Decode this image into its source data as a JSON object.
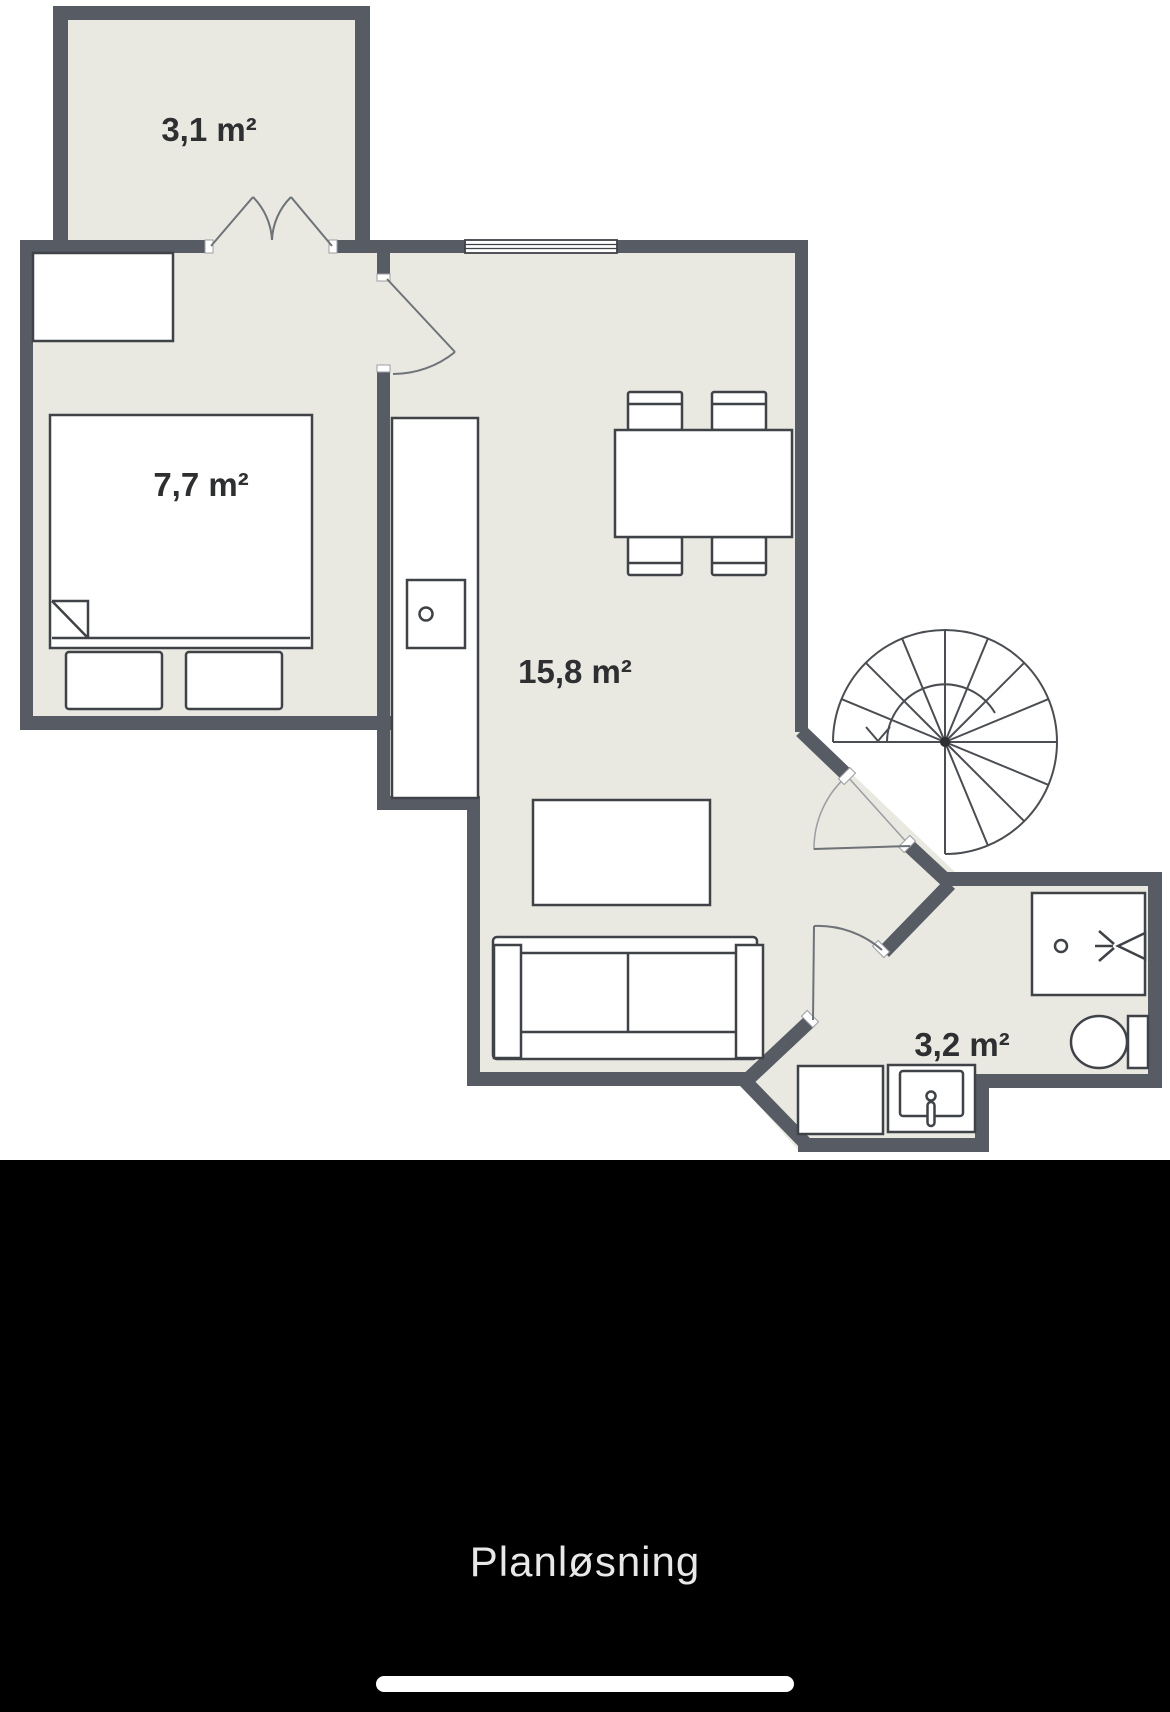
{
  "image_viewer": {
    "caption": "Planløsning"
  },
  "floorplan": {
    "rooms": [
      {
        "name": "balcony",
        "area": "3,1 m²"
      },
      {
        "name": "bedroom",
        "area": "7,7 m²"
      },
      {
        "name": "living-room-kitchen",
        "area": "15,8 m²"
      },
      {
        "name": "bathroom",
        "area": "3,2 m²"
      }
    ],
    "fixture_icons": [
      "wardrobe-icon",
      "double-bed-icon",
      "pillow-icon",
      "kitchen-counter-icon",
      "stove-icon",
      "dining-table-icon",
      "chair-icon",
      "coffee-table-icon",
      "sofa-icon",
      "spiral-staircase-icon",
      "door-swing-icon",
      "window-icon",
      "shower-icon",
      "toilet-icon",
      "washbasin-icon",
      "washing-machine-icon"
    ]
  },
  "colors": {
    "wall": "#565b64",
    "floor": "#e9e8e1",
    "furniture": "#ffffff",
    "outline": "#3f4247",
    "label": "#2e2f31",
    "background": "#ffffff",
    "band": "#000000",
    "caption_text": "#e8e8e8",
    "home_indicator": "#ffffff"
  }
}
